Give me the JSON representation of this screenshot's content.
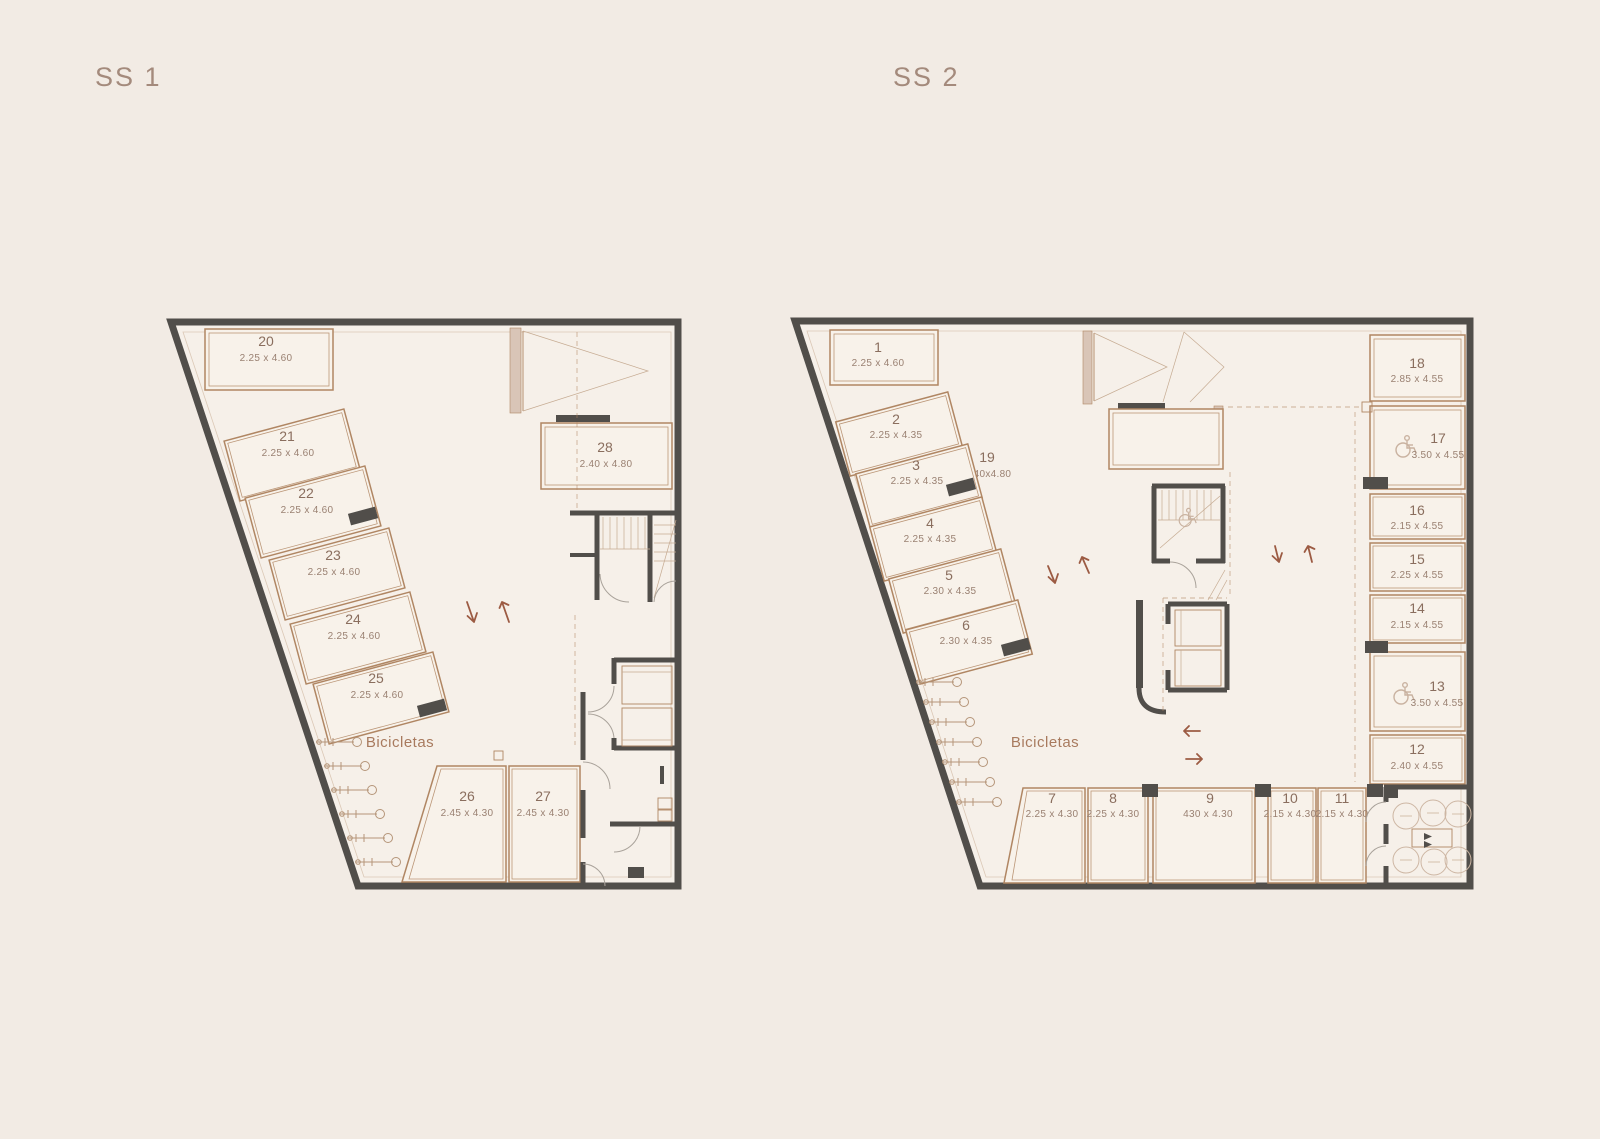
{
  "canvas": {
    "bg": "#f2ebe4"
  },
  "palette": {
    "wall": "#514e4a",
    "accent": "#b08663",
    "accent_light": "#d9c5b7",
    "number_text": "#8a6e5e",
    "dim_text": "#9a8172",
    "title_text": "#a48a7c",
    "arrow": "#9c5b43",
    "bikes_text": "#a87a5e"
  },
  "plans": [
    {
      "title": "SS 1",
      "bikes_label": "Bicicletas",
      "spaces": [
        {
          "num": "20",
          "dim": "2.25 x 4.60"
        },
        {
          "num": "21",
          "dim": "2.25 x 4.60"
        },
        {
          "num": "22",
          "dim": "2.25 x 4.60"
        },
        {
          "num": "23",
          "dim": "2.25 x 4.60"
        },
        {
          "num": "24",
          "dim": "2.25 x 4.60"
        },
        {
          "num": "25",
          "dim": "2.25 x 4.60"
        },
        {
          "num": "26",
          "dim": "2.45 x 4.30"
        },
        {
          "num": "27",
          "dim": "2.45 x 4.30"
        },
        {
          "num": "28",
          "dim": "2.40 x 4.80"
        }
      ]
    },
    {
      "title": "SS 2",
      "bikes_label": "Bicicletas",
      "spaces": [
        {
          "num": "1",
          "dim": "2.25 x 4.60"
        },
        {
          "num": "2",
          "dim": "2.25 x 4.35"
        },
        {
          "num": "3",
          "dim": "2.25 x 4.35"
        },
        {
          "num": "4",
          "dim": "2.25 x 4.35"
        },
        {
          "num": "5",
          "dim": "2.30 x 4.35"
        },
        {
          "num": "6",
          "dim": "2.30 x 4.35"
        },
        {
          "num": "7",
          "dim": "2.25 x 4.30"
        },
        {
          "num": "8",
          "dim": "2.25 x 4.30"
        },
        {
          "num": "9",
          "dim": "430 x 4.30"
        },
        {
          "num": "10",
          "dim": "2.15 x 4.30"
        },
        {
          "num": "11",
          "dim": "2.15 x 4.30"
        },
        {
          "num": "12",
          "dim": "2.40 x 4.55"
        },
        {
          "num": "13",
          "dim": "3.50 x 4.55"
        },
        {
          "num": "14",
          "dim": "2.15 x 4.55"
        },
        {
          "num": "15",
          "dim": "2.25 x 4.55"
        },
        {
          "num": "16",
          "dim": "2.15 x 4.55"
        },
        {
          "num": "17",
          "dim": "3.50 x 4.55"
        },
        {
          "num": "18",
          "dim": "2.85 x 4.55"
        },
        {
          "num": "19",
          "dim": "2.40x4.80"
        }
      ]
    }
  ]
}
